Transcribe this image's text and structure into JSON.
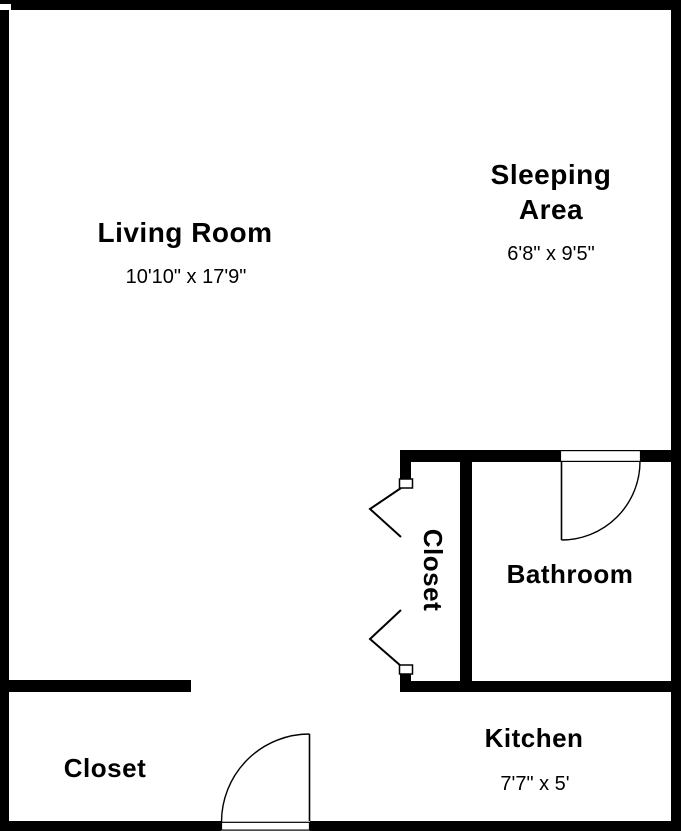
{
  "colors": {
    "walls": "#000000",
    "floor": "#ffffff",
    "text": "#000000",
    "door_lines": "#000000"
  },
  "rooms": {
    "living": {
      "label": "Living Room",
      "dims": "10'10\" x 17'9\""
    },
    "sleeping": {
      "label": "Sleeping Area",
      "dims": "6'8\" x 9'5\""
    },
    "closet_hall": {
      "label": "Closet"
    },
    "bathroom": {
      "label": "Bathroom"
    },
    "kitchen": {
      "label": "Kitchen",
      "dims": "7'7\" x 5'"
    },
    "closet_entry": {
      "label": "Closet"
    }
  }
}
